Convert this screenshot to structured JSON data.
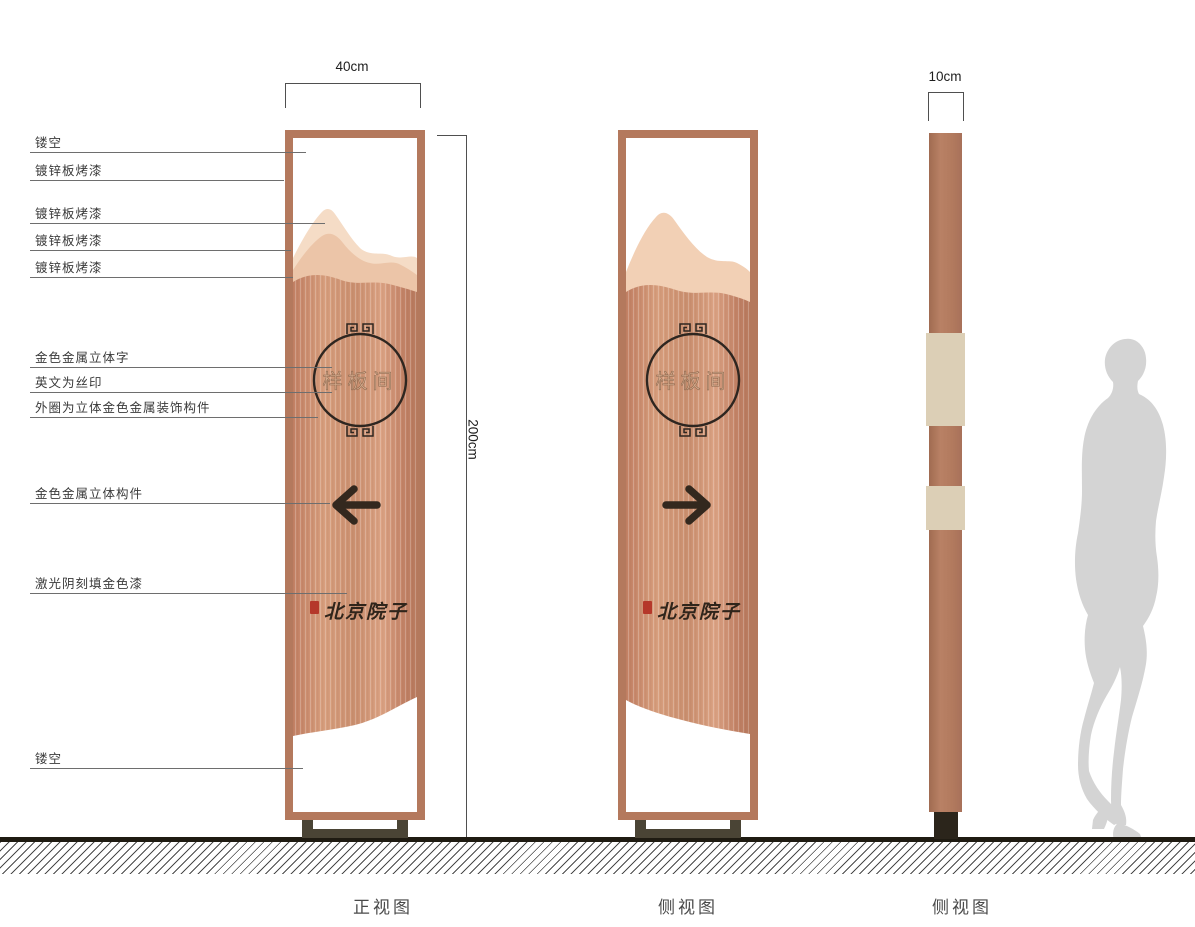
{
  "annotations": {
    "items": [
      {
        "label": "镂空"
      },
      {
        "label": "镀锌板烤漆"
      },
      {
        "label": "镀锌板烤漆"
      },
      {
        "label": "镀锌板烤漆"
      },
      {
        "label": "镀锌板烤漆"
      },
      {
        "label": "金色金属立体字"
      },
      {
        "label": "英文为丝印"
      },
      {
        "label": "外圈为立体金色金属装饰构件"
      },
      {
        "label": "金色金属立体构件"
      },
      {
        "label": "激光阴刻填金色漆"
      },
      {
        "label": "镂空"
      }
    ]
  },
  "dimensions": {
    "front_width": "40cm",
    "height": "200cm",
    "side_width": "10cm"
  },
  "sign": {
    "room_label": "样板间",
    "brand": "北京院子"
  },
  "views": {
    "front": "正视图",
    "side1": "侧视图",
    "side2": "侧视图"
  },
  "colors": {
    "copper_frame": "#b4795d",
    "copper_body_mid": "#cf9273",
    "mountain_light": "#f5dcc6",
    "mountain_mid": "#ecc5a8",
    "ring_dark": "#2e2620",
    "arrow_dark": "#33281e",
    "seal_red": "#b5382a",
    "base_olive": "#4a4435",
    "strip_beige": "#dccfb6",
    "silhouette_gray": "#d4d4d4"
  }
}
